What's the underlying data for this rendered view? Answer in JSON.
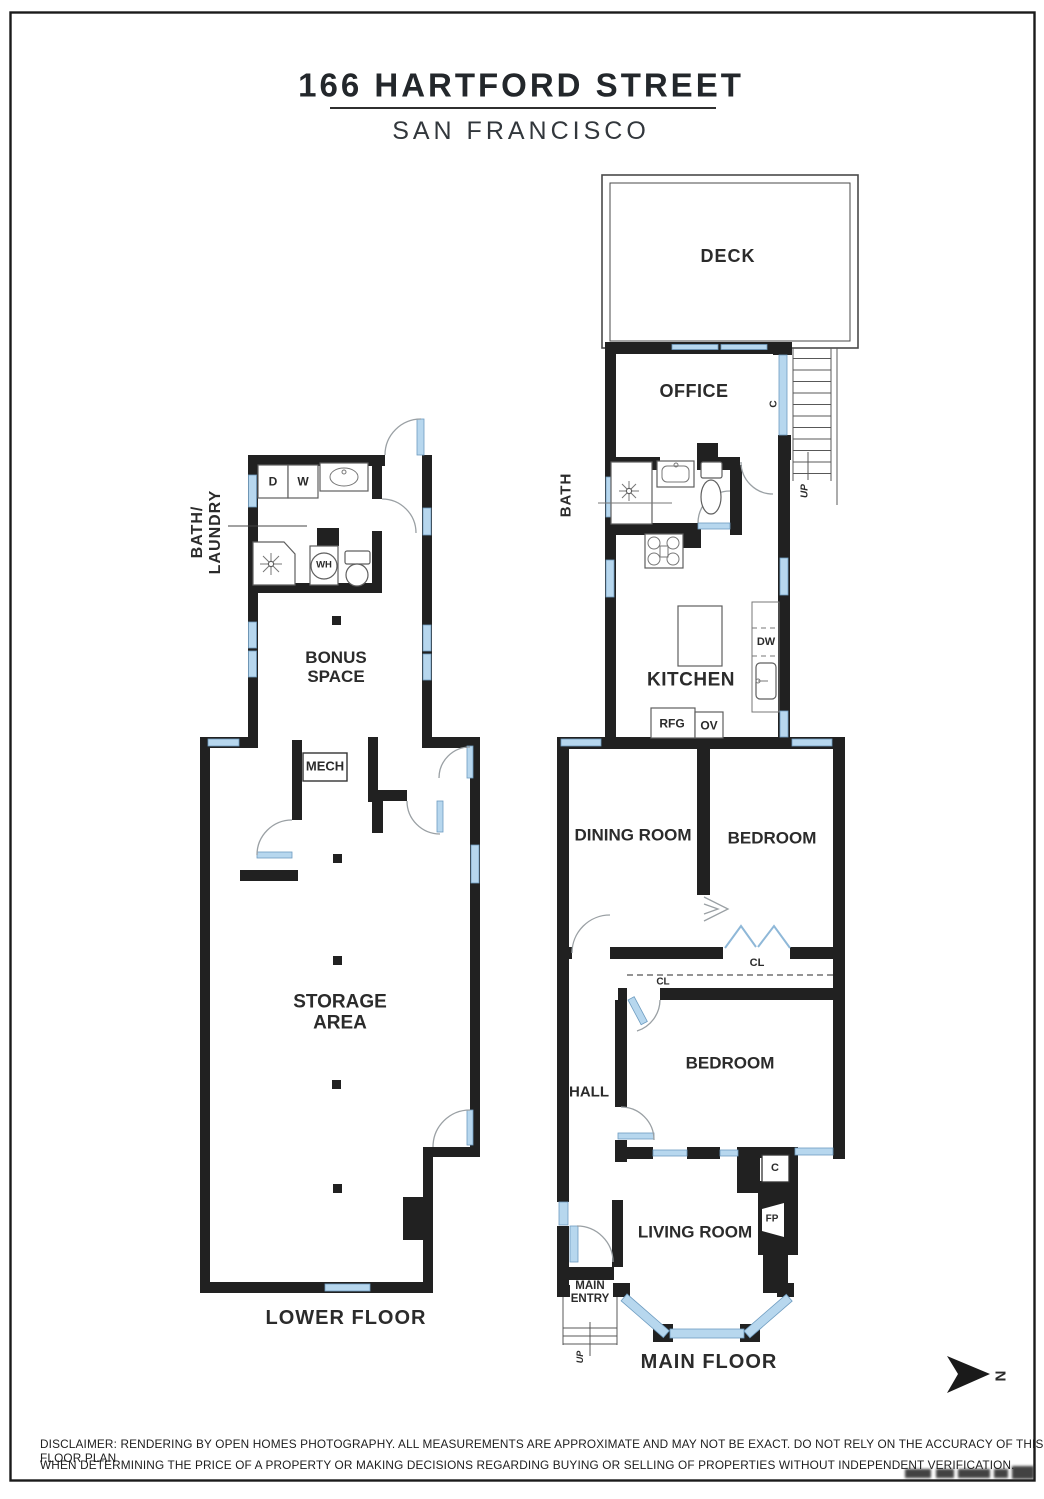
{
  "page": {
    "title": "166 HARTFORD STREET",
    "subtitle": "SAN FRANCISCO",
    "compass_label": "N",
    "disclaimer_line1": "DISCLAIMER: RENDERING BY OPEN HOMES PHOTOGRAPHY. ALL MEASUREMENTS ARE APPROXIMATE AND MAY NOT BE EXACT. DO NOT RELY ON THE ACCURACY OF THIS FLOOR PLAN",
    "disclaimer_line2": "WHEN DETERMINING THE PRICE OF A PROPERTY OR MAKING DECISIONS REGARDING BUYING OR SELLING OF PROPERTIES WITHOUT INDEPENDENT VERIFICATION."
  },
  "lower_floor": {
    "floor_label": "LOWER FLOOR",
    "bath_laundry_line1": "BATH/",
    "bath_laundry_line2": "LAUNDRY",
    "dryer": "D",
    "washer": "W",
    "water_heater": "WH",
    "bonus_line1": "BONUS",
    "bonus_line2": "SPACE",
    "mech": "MECH",
    "storage_line1": "STORAGE",
    "storage_line2": "AREA"
  },
  "main_floor": {
    "floor_label": "MAIN FLOOR",
    "deck": "DECK",
    "office": "OFFICE",
    "office_closet": "C",
    "stairs_up": "UP",
    "bath": "BATH",
    "kitchen": "KITCHEN",
    "dishwasher": "DW",
    "refrigerator": "RFG",
    "oven": "OV",
    "dining_room": "DINING ROOM",
    "bedroom_rear": "BEDROOM",
    "closet_rear": "CL",
    "closet_hall": "CL",
    "hall": "HALL",
    "bedroom_front": "BEDROOM",
    "closet_living": "C",
    "fireplace": "FP",
    "living_room": "LIVING ROOM",
    "entry_line1": "MAIN",
    "entry_line2": "ENTRY",
    "entry_up": "UP"
  },
  "colors": {
    "wall": "#212121",
    "window_fill": "#b7d7ee",
    "window_edge": "#6e9cc0",
    "arc": "#9aa0a4",
    "text": "#2b2b2b"
  }
}
